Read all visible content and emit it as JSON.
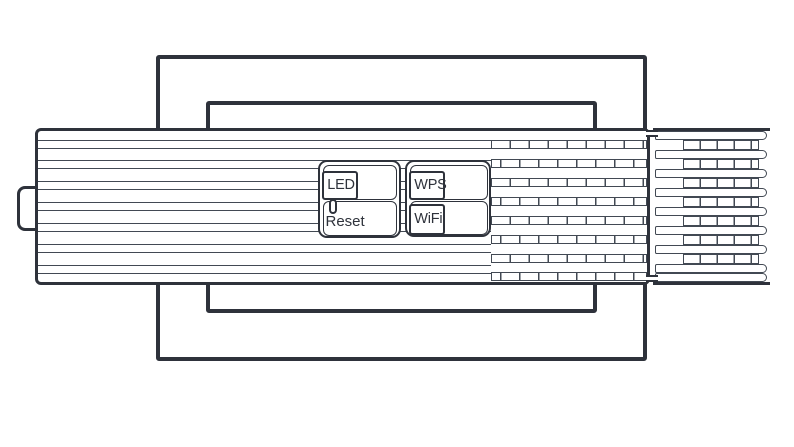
{
  "labels": {
    "led": "LED",
    "reset": "Reset",
    "wps": "WPS",
    "wifi": "WiFi"
  },
  "colors": {
    "line": "#2e323b",
    "line_thin": "#424953",
    "background": "#ffffff"
  }
}
